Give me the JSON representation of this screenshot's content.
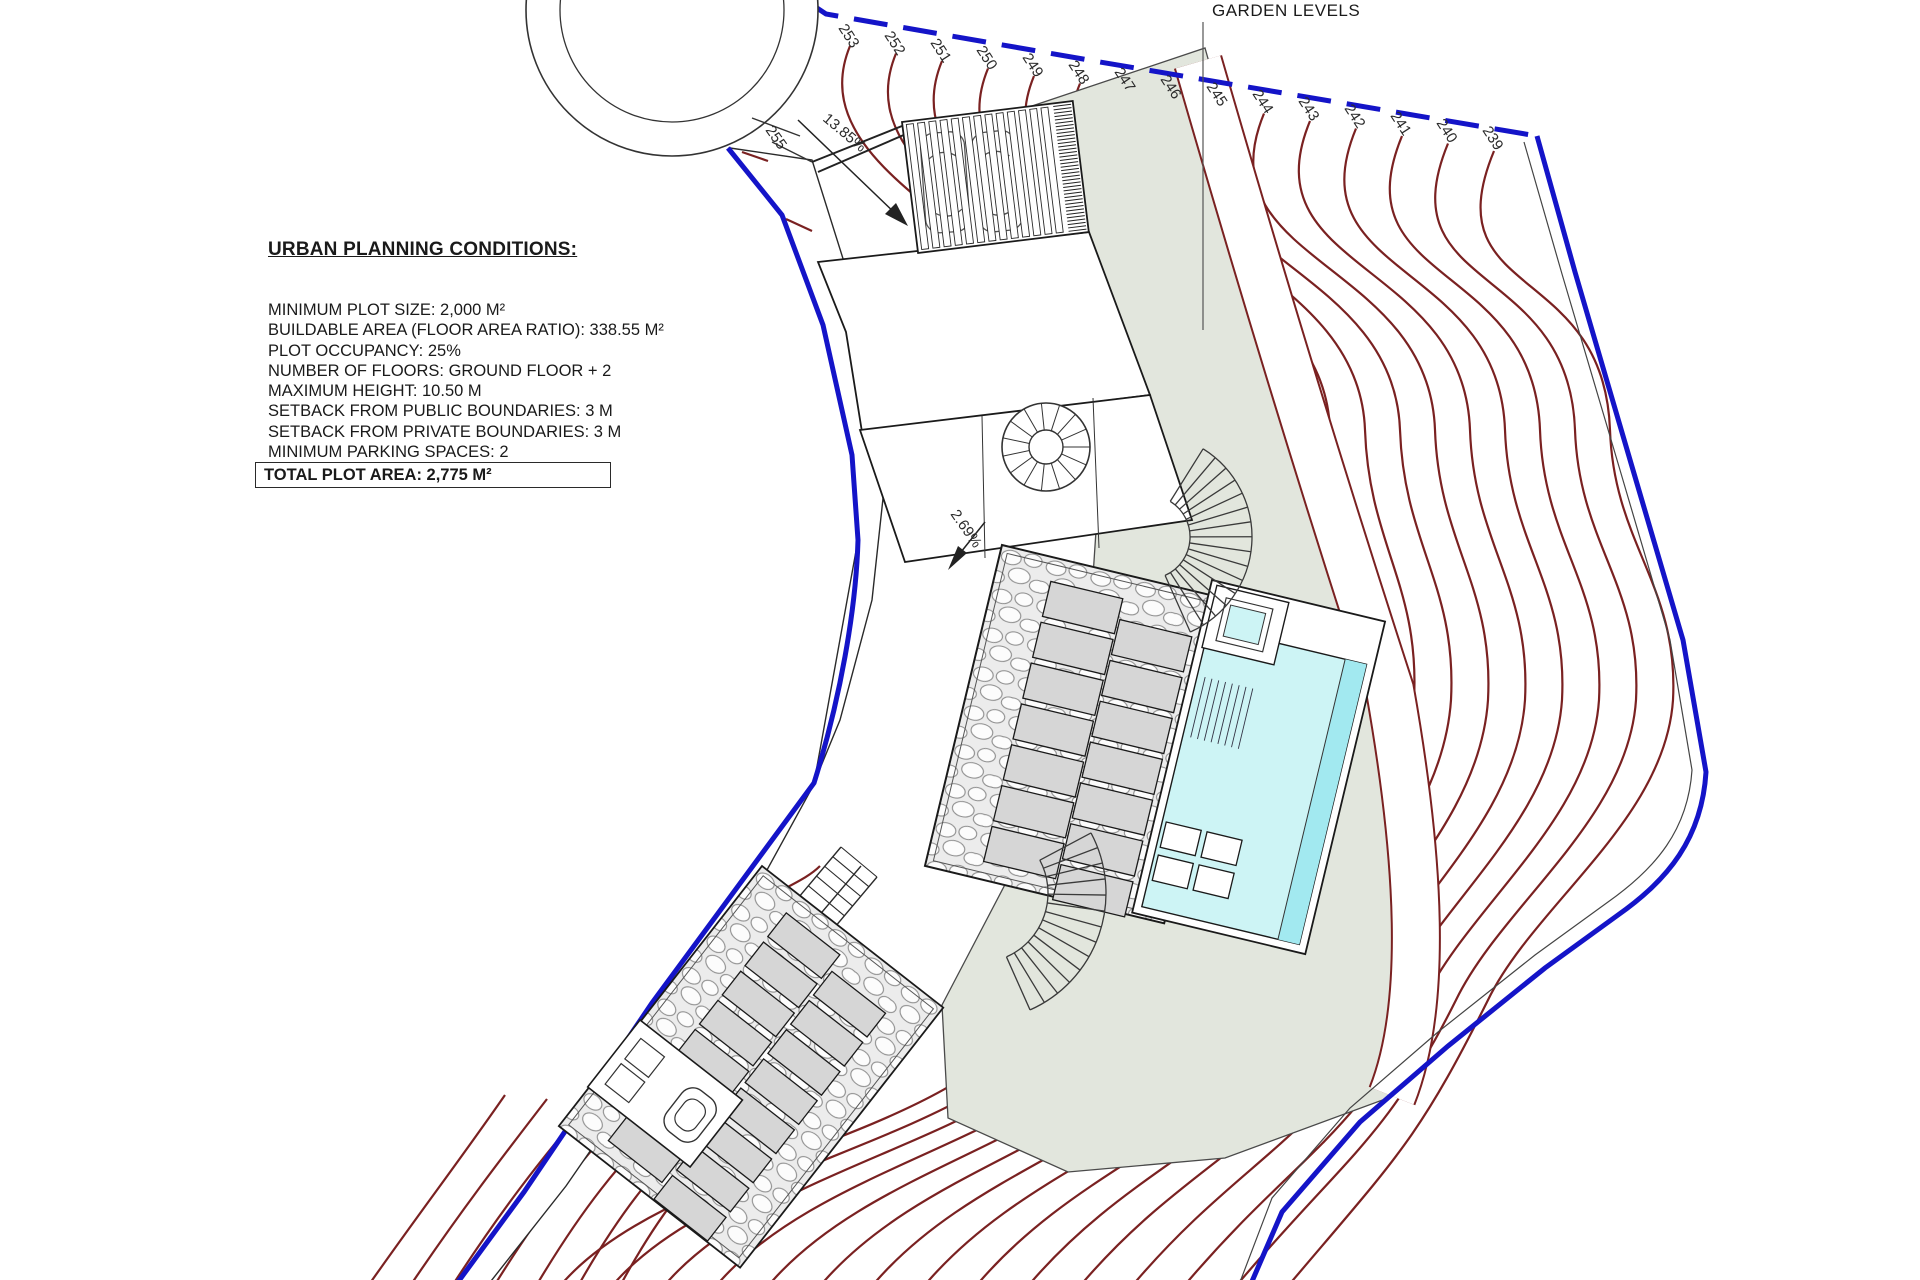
{
  "title_block": {
    "heading": "URBAN PLANNING CONDITIONS:",
    "conditions": [
      "MINIMUM PLOT SIZE: 2,000 M²",
      "BUILDABLE AREA (FLOOR AREA RATIO): 338.55 M²",
      "PLOT OCCUPANCY: 25%",
      "NUMBER OF FLOORS: GROUND FLOOR + 2",
      "MAXIMUM HEIGHT: 10.50 M",
      "SETBACK FROM PUBLIC BOUNDARIES: 3 M",
      "SETBACK FROM PRIVATE BOUNDARIES: 3 M",
      "MINIMUM PARKING SPACES: 2"
    ],
    "total_plot_area": "TOTAL PLOT AREA: 2,775 M²"
  },
  "plan": {
    "garden_label": "GARDEN LEVELS",
    "contour_labels": [
      "253",
      "252",
      "251",
      "250",
      "249",
      "248",
      "247",
      "246",
      "245",
      "244",
      "243",
      "242",
      "241",
      "240",
      "239"
    ],
    "road_level_label": "255",
    "slope_labels": {
      "driveway": "13.85%",
      "path": "2.69%"
    },
    "colors": {
      "boundary": "#1414c8",
      "contour": "#7a2121",
      "garden": "#e2e6dd",
      "pool": "#cdf4f5",
      "pool_edge": "#a2e9f0",
      "paver": "#d6d6d6"
    },
    "counts": {
      "cars": 2,
      "upper_terrace_pavers": 14,
      "lower_terrace_pavers": 16
    }
  }
}
